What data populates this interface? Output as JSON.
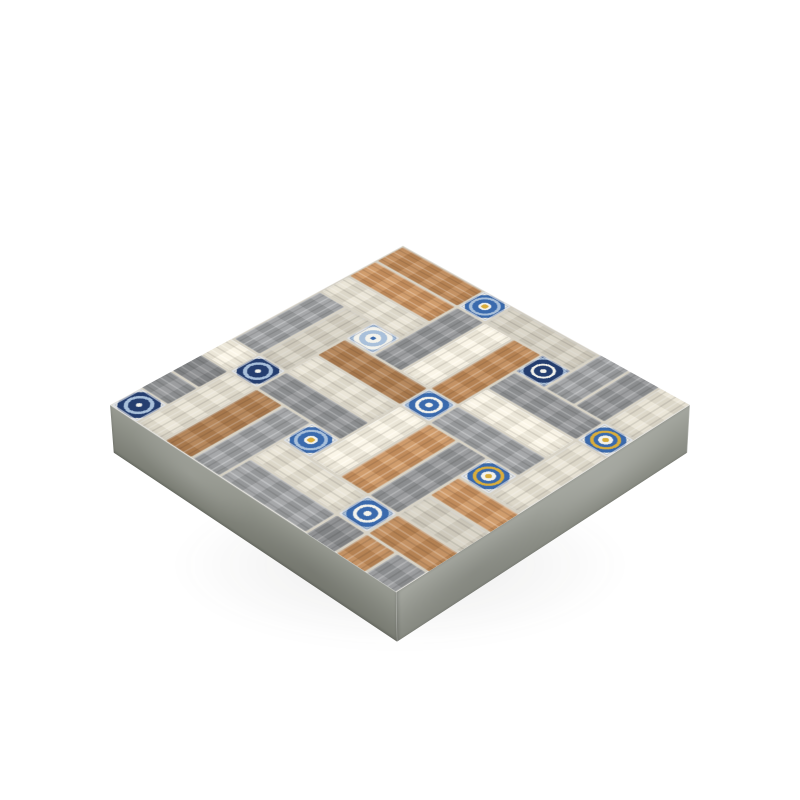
{
  "subject": "wood-look patchwork paver tile slab on white background",
  "palette": {
    "background": "#ffffff",
    "grout": "#d8d3c6",
    "wood_grey": "#949698",
    "wood_cream": "#eae4d5",
    "wood_tan": "#c08a58",
    "inlay_blue": "#3a6aad",
    "inlay_navy": "#253e6f",
    "inlay_gold": "#d9ad3c",
    "inlay_white": "#f4f3ec",
    "inlay_lightblue": "#a9c0da",
    "side_front_left": "#878a80",
    "side_front_right": "#969990"
  },
  "geometry": {
    "grid_units": 10,
    "unit_px": 41,
    "thickness_px": 60,
    "rotate_x_deg": 56,
    "rotate_z_deg": 45,
    "perspective_px": 3000,
    "perspective_origin": "55% 35%",
    "center_x": 400,
    "center_y": 405
  },
  "tile": {
    "wood_color_keys": {
      "g": "wood_grey",
      "c": "wood_cream",
      "t": "wood_tan"
    },
    "planks": [
      {
        "x": 0,
        "y": 0,
        "o": "h",
        "c": "t",
        "s": 0
      },
      {
        "x": 0,
        "y": 1,
        "o": "h",
        "c": "t",
        "s": 1
      },
      {
        "x": 0,
        "y": 2,
        "o": "h",
        "c": "c",
        "s": 0
      },
      {
        "x": 6,
        "y": 2,
        "o": "h",
        "c": "g",
        "s": 0
      },
      {
        "x": 6,
        "y": 3,
        "o": "h",
        "c": "c",
        "s": 1
      },
      {
        "x": 6,
        "y": 4,
        "o": "h",
        "c": "g",
        "s": 1
      },
      {
        "x": 2,
        "y": 4,
        "o": "h",
        "c": "t",
        "s": 2
      },
      {
        "x": 2,
        "y": 5,
        "o": "h",
        "c": "c",
        "s": 0
      },
      {
        "x": 2,
        "y": 6,
        "o": "h",
        "c": "g",
        "s": 0
      },
      {
        "x": 8,
        "y": 6,
        "o": "h",
        "c": "t",
        "s": 1
      },
      {
        "x": 8,
        "y": 7,
        "o": "h",
        "c": "c",
        "s": 2
      },
      {
        "x": 8,
        "y": 8,
        "o": "h",
        "c": "t",
        "s": 0
      },
      {
        "x": -2,
        "y": 6,
        "o": "h",
        "c": "c",
        "s": 1
      },
      {
        "x": -2,
        "y": 7,
        "o": "h",
        "c": "g",
        "s": 2
      },
      {
        "x": -2,
        "y": 8,
        "o": "h",
        "c": "g",
        "s": 0
      },
      {
        "x": 4,
        "y": 8,
        "o": "h",
        "c": "c",
        "s": 0
      },
      {
        "x": 4,
        "y": 9,
        "o": "h",
        "c": "g",
        "s": 1
      },
      {
        "x": 4,
        "y": 0,
        "o": "h",
        "c": "c",
        "s": 2
      },
      {
        "x": 3,
        "y": 1,
        "o": "v",
        "c": "g",
        "s": 0
      },
      {
        "x": 4,
        "y": 1,
        "o": "v",
        "c": "c",
        "s": 1
      },
      {
        "x": 5,
        "y": 1,
        "o": "v",
        "c": "t",
        "s": 0
      },
      {
        "x": 9,
        "y": 3,
        "o": "v",
        "c": "c",
        "s": 0
      },
      {
        "x": 0,
        "y": 3,
        "o": "v",
        "c": "g",
        "s": 1
      },
      {
        "x": 1,
        "y": 3,
        "o": "v",
        "c": "c",
        "s": 2
      },
      {
        "x": 5,
        "y": 5,
        "o": "v",
        "c": "c",
        "s": 1
      },
      {
        "x": 6,
        "y": 5,
        "o": "v",
        "c": "t",
        "s": 1
      },
      {
        "x": 7,
        "y": 5,
        "o": "v",
        "c": "g",
        "s": 0
      },
      {
        "x": 1,
        "y": 7,
        "o": "v",
        "c": "c",
        "s": 0
      },
      {
        "x": 2,
        "y": 7,
        "o": "v",
        "c": "t",
        "s": 2
      },
      {
        "x": 3,
        "y": 7,
        "o": "v",
        "c": "g",
        "s": 1
      },
      {
        "x": 7,
        "y": 9,
        "o": "v",
        "c": "g",
        "s": 2
      },
      {
        "x": 8,
        "y": 9,
        "o": "v",
        "c": "t",
        "s": 0
      },
      {
        "x": 9,
        "y": 9,
        "o": "v",
        "c": "g",
        "s": 0
      },
      {
        "x": 7,
        "y": -1,
        "o": "v",
        "c": "g",
        "s": 1
      },
      {
        "x": 8,
        "y": -1,
        "o": "v",
        "c": "g",
        "s": 0
      },
      {
        "x": 9,
        "y": -1,
        "o": "v",
        "c": "c",
        "s": 0
      }
    ],
    "inlays": [
      {
        "x": 3,
        "y": 0,
        "m": "star"
      },
      {
        "x": 6,
        "y": 1,
        "m": "damask_dark"
      },
      {
        "x": 9,
        "y": 2,
        "m": "arab_gold"
      },
      {
        "x": 2,
        "y": 3,
        "m": "snowflake"
      },
      {
        "x": 5,
        "y": 4,
        "m": "damask_blue"
      },
      {
        "x": 8,
        "y": 5,
        "m": "arab_gold"
      },
      {
        "x": 1,
        "y": 6,
        "m": "medallion_dark"
      },
      {
        "x": 4,
        "y": 7,
        "m": "star"
      },
      {
        "x": 7,
        "y": 8,
        "m": "damask_blue"
      },
      {
        "x": 0,
        "y": 9,
        "m": "medallion_dark"
      }
    ]
  }
}
